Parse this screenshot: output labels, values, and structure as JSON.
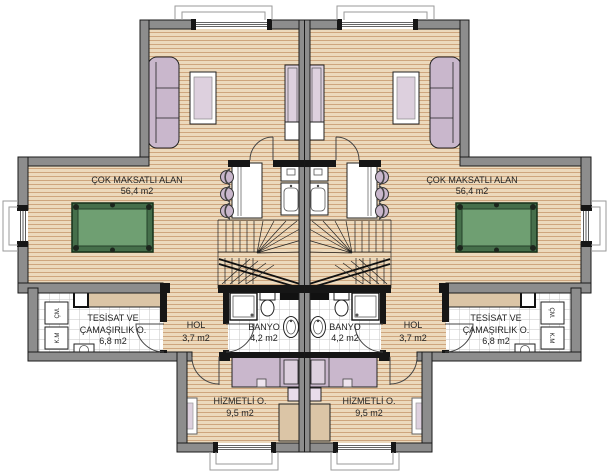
{
  "palette": {
    "wood": "#ecd9bc",
    "woodline": "#c49468",
    "wallgray": "#8d8d8d",
    "wallblack": "#161616",
    "tileline": "#c6c6c6",
    "felt": "#6f9f72",
    "feltframe": "#466f4b",
    "purple": "#c9b7cc",
    "purplelight": "#ddd0de",
    "tan": "#dbc5a6",
    "ink": "#222222",
    "sill": "#9a9a9a"
  },
  "labels": {
    "multi_purpose": {
      "name": "ÇOK MAKSATLI ALAN",
      "area": "56,4 m2"
    },
    "utility": {
      "name_line1": "TESİSAT VE",
      "name_line2": "ÇAMAŞIRLIK O.",
      "area": "6,8 m2"
    },
    "hall": {
      "name": "HOL",
      "area": "3,7 m2"
    },
    "bathroom": {
      "name": "BANYO",
      "area": "4,2 m2"
    },
    "maid_room": {
      "name": "HİZMETLİ O.",
      "area": "9,5 m2"
    },
    "washing_machine": "ÇM.",
    "dryer": "K.M"
  }
}
